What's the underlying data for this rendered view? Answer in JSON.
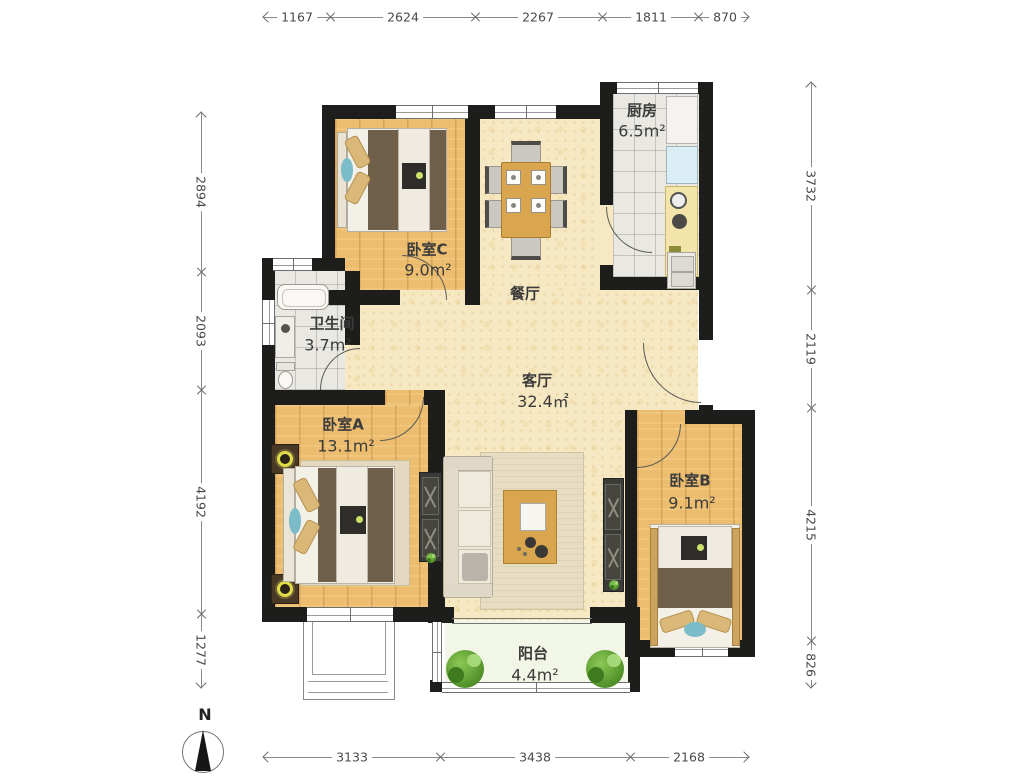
{
  "plan_title": "3-bedroom apartment floor plan",
  "rooms": [
    {
      "id": "kitchen",
      "name": "厨房",
      "area": "6.5m²"
    },
    {
      "id": "bedroomC",
      "name": "卧室C",
      "area": "9.0m²"
    },
    {
      "id": "dining",
      "name": "餐厅",
      "area": ""
    },
    {
      "id": "bathroom",
      "name": "卫生间",
      "area": "3.7m²"
    },
    {
      "id": "living",
      "name": "客厅",
      "area": "32.4㎡"
    },
    {
      "id": "bedroomA",
      "name": "卧室A",
      "area": "13.1m²"
    },
    {
      "id": "bedroomB",
      "name": "卧室B",
      "area": "9.1m²"
    },
    {
      "id": "balcony",
      "name": "阳台",
      "area": "4.4m²"
    }
  ],
  "dimensions": {
    "top": [
      "1167",
      "2624",
      "2267",
      "1811",
      "870"
    ],
    "left": [
      "2894",
      "2093",
      "4192",
      "1277"
    ],
    "right": [
      "3732",
      "2119",
      "4215",
      "826"
    ],
    "bottom": [
      "3133",
      "3438",
      "2168"
    ]
  },
  "compass": {
    "label": "N"
  },
  "colors": {
    "wall": "#1d1d1b",
    "wood_floor": "#ecbd6f",
    "public_floor": "#f6e8c2",
    "tile_floor": "#eae8e3",
    "balcony_floor": "#f2f6e6",
    "accent_teal": "#7bbcc8",
    "blanket_brown": "#70604a",
    "counter_yellow": "#f2e4aa",
    "plant_green": "#4e8f27"
  }
}
